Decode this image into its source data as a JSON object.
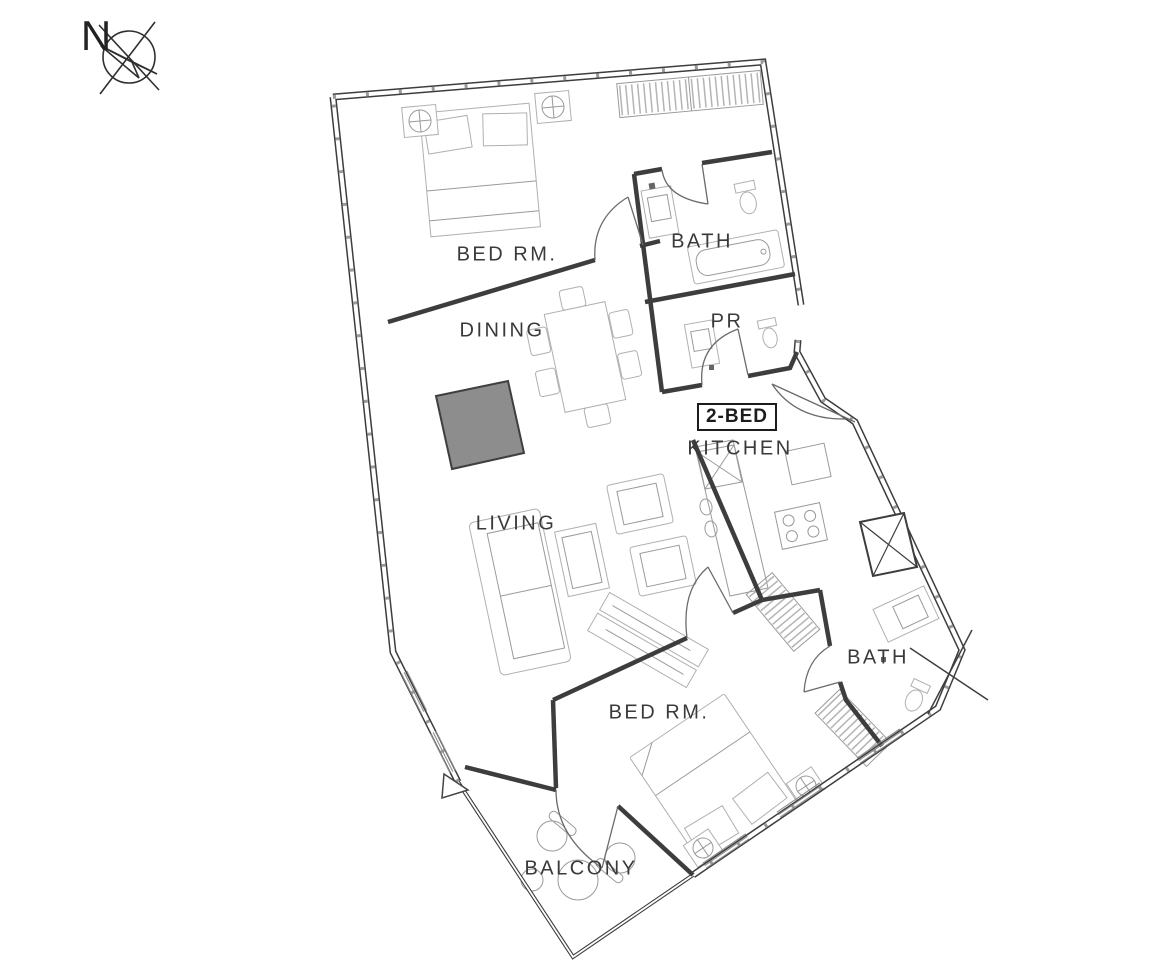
{
  "compass": {
    "label": "N"
  },
  "unit": {
    "type_label": "2-BED"
  },
  "rooms": {
    "bedroom_top": "BED RM.",
    "bath_top": "BATH",
    "dining": "DINING",
    "pr": "PR",
    "kitchen": "KITCHEN",
    "living": "LIVING",
    "bath_bottom": "BATH",
    "bedroom_bottom": "BED RM.",
    "balcony": "BALCONY"
  },
  "colors": {
    "background": "#ffffff",
    "wall": "#3d3d3d",
    "furniture_line": "#b0b0b0",
    "shaft_fill": "#8d8d8d",
    "shaft_border": "#3f3f3f",
    "label_text": "#3a3a3a"
  }
}
